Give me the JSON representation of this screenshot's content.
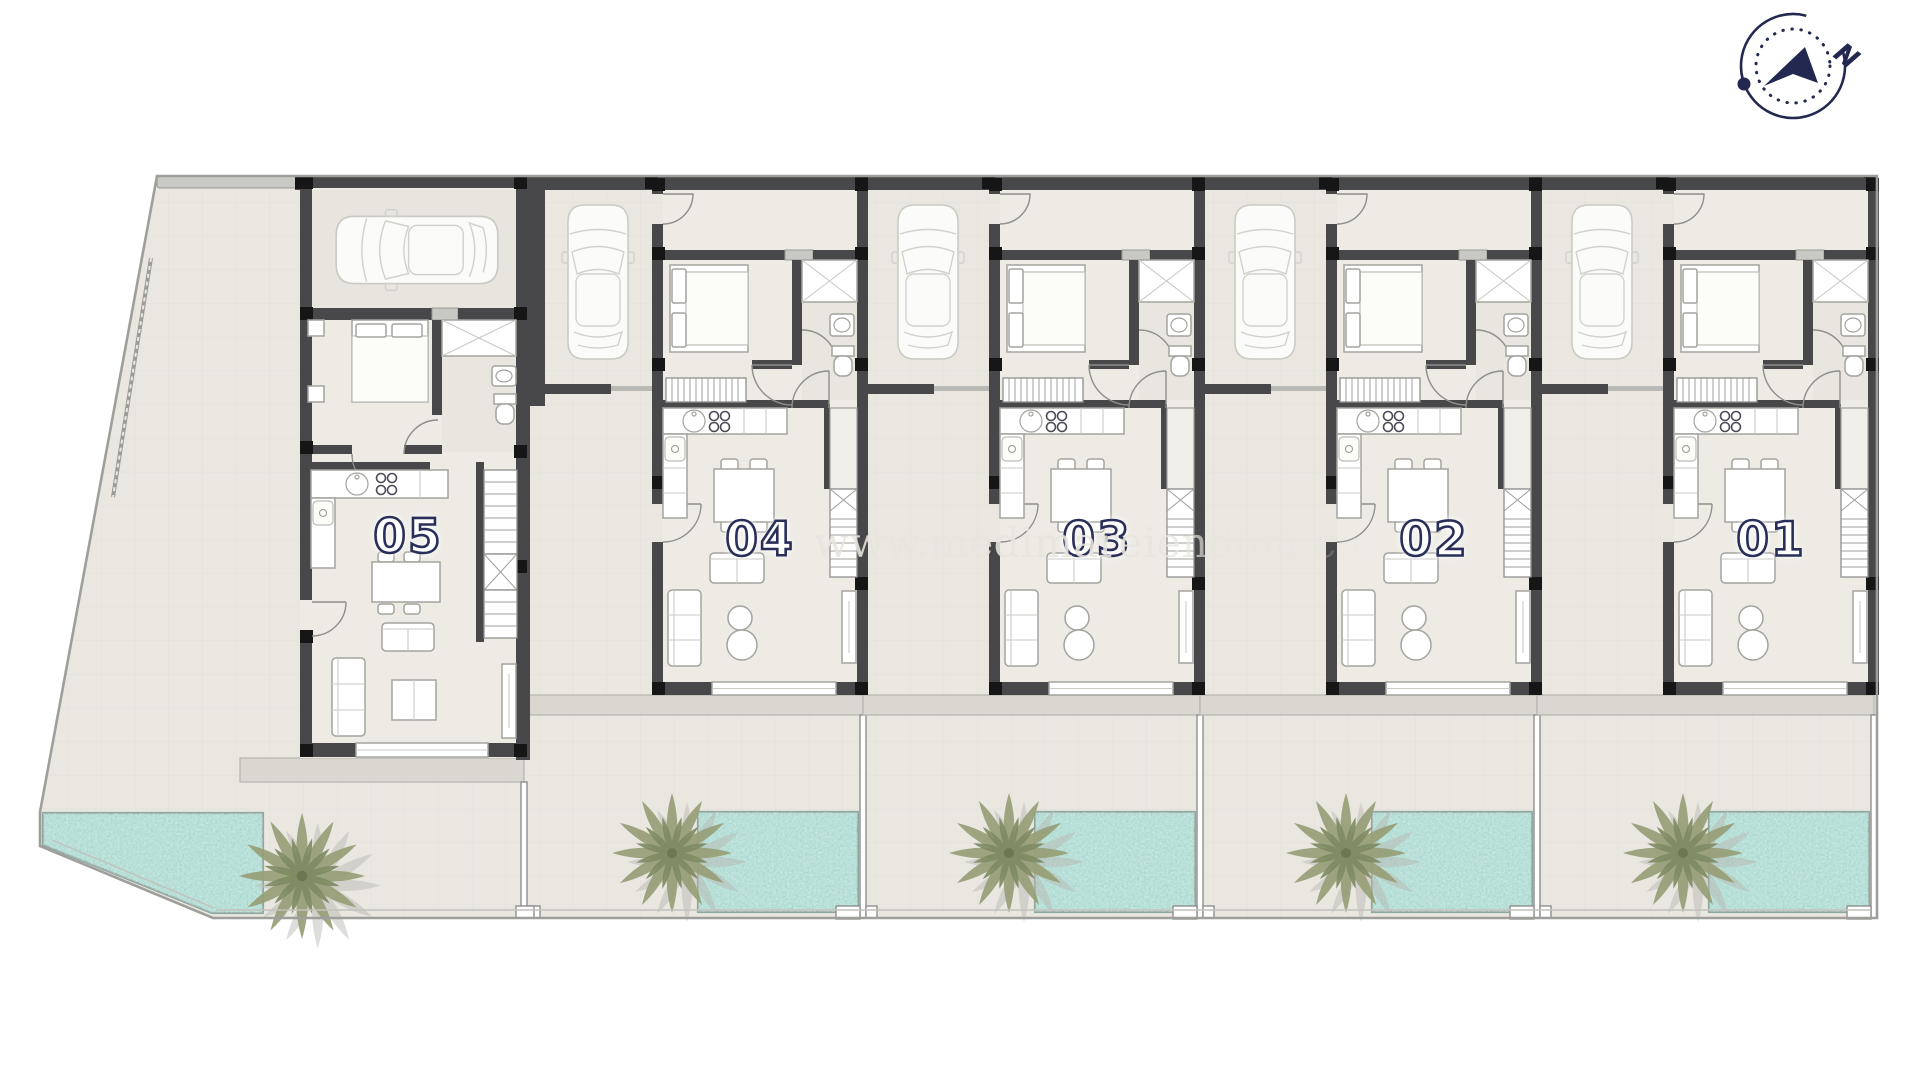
{
  "page": {
    "background": "#ffffff"
  },
  "compass": {
    "north_label": "N"
  },
  "watermark": {
    "text": "www.medimareiendom.com"
  },
  "units": [
    {
      "id": "unit-05",
      "number": "05"
    },
    {
      "id": "unit-04",
      "number": "04"
    },
    {
      "id": "unit-03",
      "number": "03"
    },
    {
      "id": "unit-02",
      "number": "02"
    },
    {
      "id": "unit-01",
      "number": "01"
    }
  ],
  "palette": {
    "page_bg": "#ffffff",
    "wall": "#48484a",
    "wall_block": "#161616",
    "wall_light": "#c8c8c5",
    "floor_indoor": "#edebe4",
    "floor_outdoor": "#e9e7e0",
    "floor_tile_line": "#dfddd5",
    "terrace": "#d9d7d0",
    "pool_water": "#a7d8ce",
    "pool_edge": "#8fa9a2",
    "palm_leaf": "#979f77",
    "palm_leaf_dark": "#7e8a61",
    "palm_shadow": "#b7b6b0",
    "furniture_line": "#a3a39f",
    "door_line": "#8e8e8a",
    "boundary": "#9e9e9a",
    "label_fill": "#ffffff",
    "label_outline": "#2a2f5a",
    "compass_ink": "#232850"
  }
}
